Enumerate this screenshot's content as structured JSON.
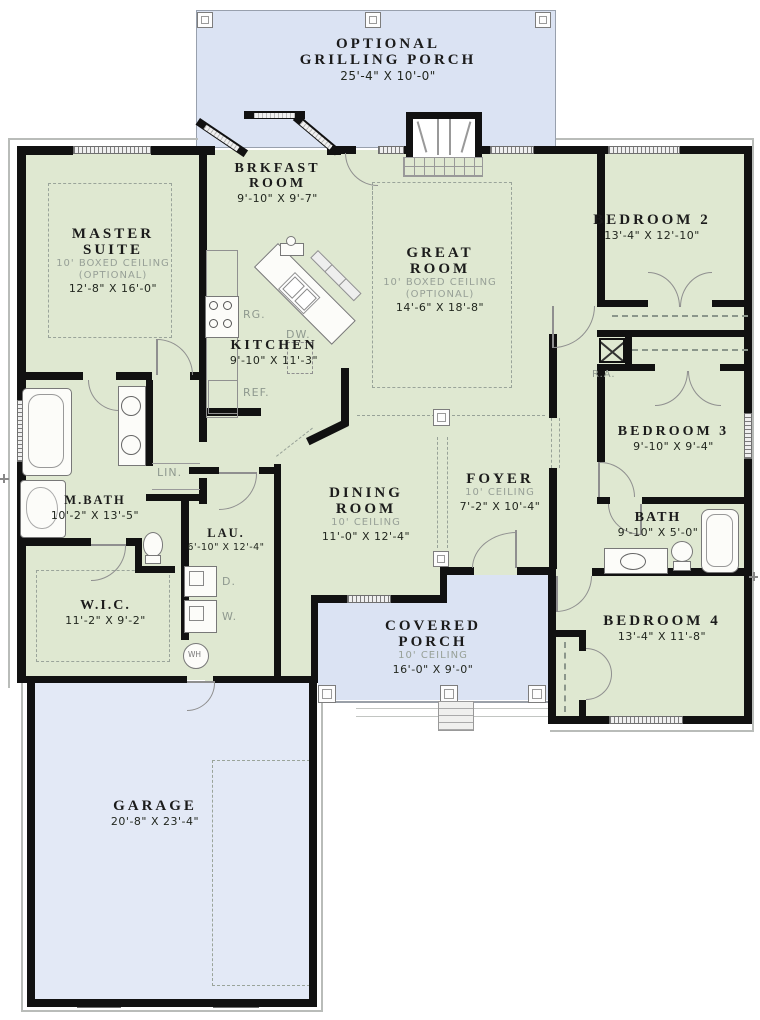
{
  "rooms": {
    "grill": {
      "l1": "OPTIONAL",
      "l2": "GRILLING PORCH",
      "dims": "25'-4\" X 10'-0\""
    },
    "master": {
      "l1": "MASTER",
      "l2": "SUITE",
      "c1": "10' BOXED CEILING",
      "c2": "(OPTIONAL)",
      "dims": "12'-8\" X 16'-0\""
    },
    "brkfast": {
      "l1": "BRKFAST",
      "l2": "ROOM",
      "dims": "9'-10\" X 9'-7\""
    },
    "great": {
      "l1": "GREAT",
      "l2": "ROOM",
      "c1": "10' BOXED CEILING",
      "c2": "(OPTIONAL)",
      "dims": "14'-6\" X 18'-8\""
    },
    "bedroom2": {
      "name": "BEDROOM 2",
      "dims": "13'-4\" X 12'-10\""
    },
    "kitchen": {
      "name": "KITCHEN",
      "dims": "9'-10\" X 11'-3\""
    },
    "bedroom3": {
      "name": "BEDROOM 3",
      "dims": "9'-10\" X 9'-4\""
    },
    "mbath": {
      "name": "M.BATH",
      "dims": "10'-2\" X 13'-5\""
    },
    "dining": {
      "l1": "DINING",
      "l2": "ROOM",
      "c1": "10' CEILING",
      "dims": "11'-0\" X 12'-4\""
    },
    "foyer": {
      "name": "FOYER",
      "c1": "10' CEILING",
      "dims": "7'-2\" X 10'-4\""
    },
    "bath": {
      "name": "BATH",
      "dims": "9'-10\" X 5'-0\""
    },
    "lau": {
      "name": "LAU.",
      "dims": "6'-10\" X 12'-4\""
    },
    "wic": {
      "name": "W.I.C.",
      "dims": "11'-2\" X 9'-2\""
    },
    "bedroom4": {
      "name": "BEDROOM 4",
      "dims": "13'-4\" X 11'-8\""
    },
    "porch": {
      "l1": "COVERED",
      "l2": "PORCH",
      "c1": "10' CEILING",
      "dims": "16'-0\" X 9'-0\""
    },
    "garage": {
      "name": "GARAGE",
      "dims": "20'-8\" X 23'-4\""
    }
  },
  "labels": {
    "range": "RG.",
    "dishwasher": "DW.",
    "refrigerator": "REF.",
    "linen": "LIN.",
    "return_air": "R.A.",
    "dryer": "D.",
    "washer": "W.",
    "water_heater": "WH"
  },
  "colors": {
    "room_fill": "#dfe8d1",
    "porch_fill": "#dbe3f3",
    "garage_fill": "#e3e9f6",
    "wall": "#111111"
  }
}
